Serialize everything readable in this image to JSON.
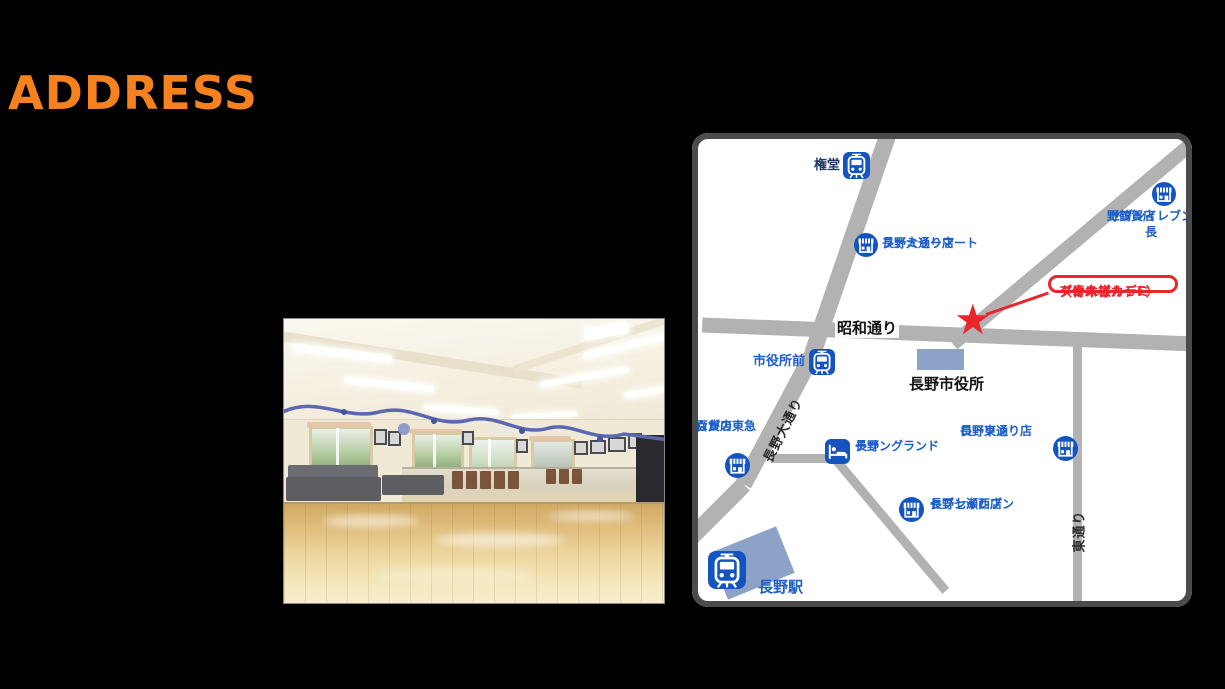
{
  "title": "ADDRESS",
  "colors": {
    "title_orange": "#F5821F",
    "background_black": "#000000",
    "map_frame_gray": "#4B4B4B",
    "road_gray": "#B2B2B2",
    "building_slate_blue": "#8CA2C6",
    "map_icon_blue": "#1454C0",
    "map_label_blue": "#1E5EC8",
    "station_label_navy": "#1F3864",
    "destination_red": "#E8262B"
  },
  "map": {
    "icons": {
      "star": "★"
    },
    "streets": {
      "showa_dori": "昭和通り",
      "nagano_odori": "長野大通り",
      "higashi_dori": "東通り"
    },
    "stations": {
      "gondo": "権堂",
      "shiyakusho_mae": "市役所前",
      "nagano_station": "長野駅"
    },
    "buildings": {
      "city_hall": "長野市役所"
    },
    "places": {
      "familymart": {
        "line1": "ファミリーマート",
        "line2": "長野大通り店"
      },
      "seveneleven_tsuruga": {
        "line1": "セブンイレブン長",
        "line2": "野鶴賀店"
      },
      "nagano_tokyu": {
        "line1": "ながの東急",
        "line2": "百貨店"
      },
      "chisun_grand": {
        "line1": "チサングランド",
        "line2": "長野"
      },
      "lawson": {
        "line1": "ローソン",
        "line2": "長野東通り店"
      },
      "seveneleven_nanase": {
        "line1": "セブンイレブン",
        "line2": "長野七瀬西店"
      }
    },
    "destination": {
      "line1": "ダンスアカデミー",
      "line2": "アオキ様",
      "line3": "（青木ビル５F）"
    }
  }
}
